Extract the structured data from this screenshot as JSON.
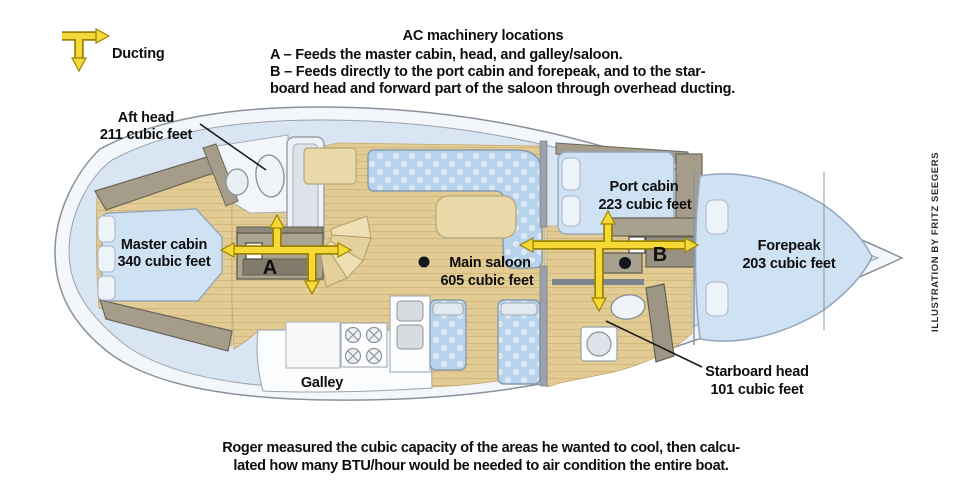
{
  "legend": {
    "label": "Ducting"
  },
  "header": {
    "title": "AC machinery locations",
    "line_a": "A – Feeds the master cabin, head, and galley/saloon.",
    "line_b1": "B – Feeds directly to the port cabin and forepeak, and to the star-",
    "line_b2": "board head and forward part of the saloon through overhead ducting."
  },
  "units": {
    "a_label": "A",
    "b_label": "B"
  },
  "rooms": {
    "aft_head": {
      "name": "Aft head",
      "volume": "211 cubic feet"
    },
    "master_cabin": {
      "name": "Master cabin",
      "volume": "340 cubic feet"
    },
    "main_saloon": {
      "name": "Main saloon",
      "volume": "605 cubic feet"
    },
    "port_cabin": {
      "name": "Port cabin",
      "volume": "223 cubic feet"
    },
    "forepeak": {
      "name": "Forepeak",
      "volume": "203 cubic feet"
    },
    "starboard_head": {
      "name": "Starboard head",
      "volume": "101 cubic feet"
    },
    "galley": {
      "name": "Galley"
    }
  },
  "caption": {
    "line1": "Roger measured the cubic capacity of the areas he wanted to cool, then calcu-",
    "line2": "lated how many BTU/hour would be needed to air condition the entire boat."
  },
  "credit": "ILLUSTRATION BY FRITZ SEEGERS",
  "colors": {
    "ducting_yellow": "#f6d936",
    "ducting_outline": "#9a8300",
    "deck_blue": "#d9e5f2",
    "hull_white": "#f3f7fb",
    "floor_tan": "#e2cc94",
    "furniture_taupe": "#a59d8a",
    "cushion_blue": "#cfe2f4",
    "settee_blue": "#b7d3ec",
    "table_cream": "#e9d8a8",
    "text_black": "#0e0e0e"
  }
}
